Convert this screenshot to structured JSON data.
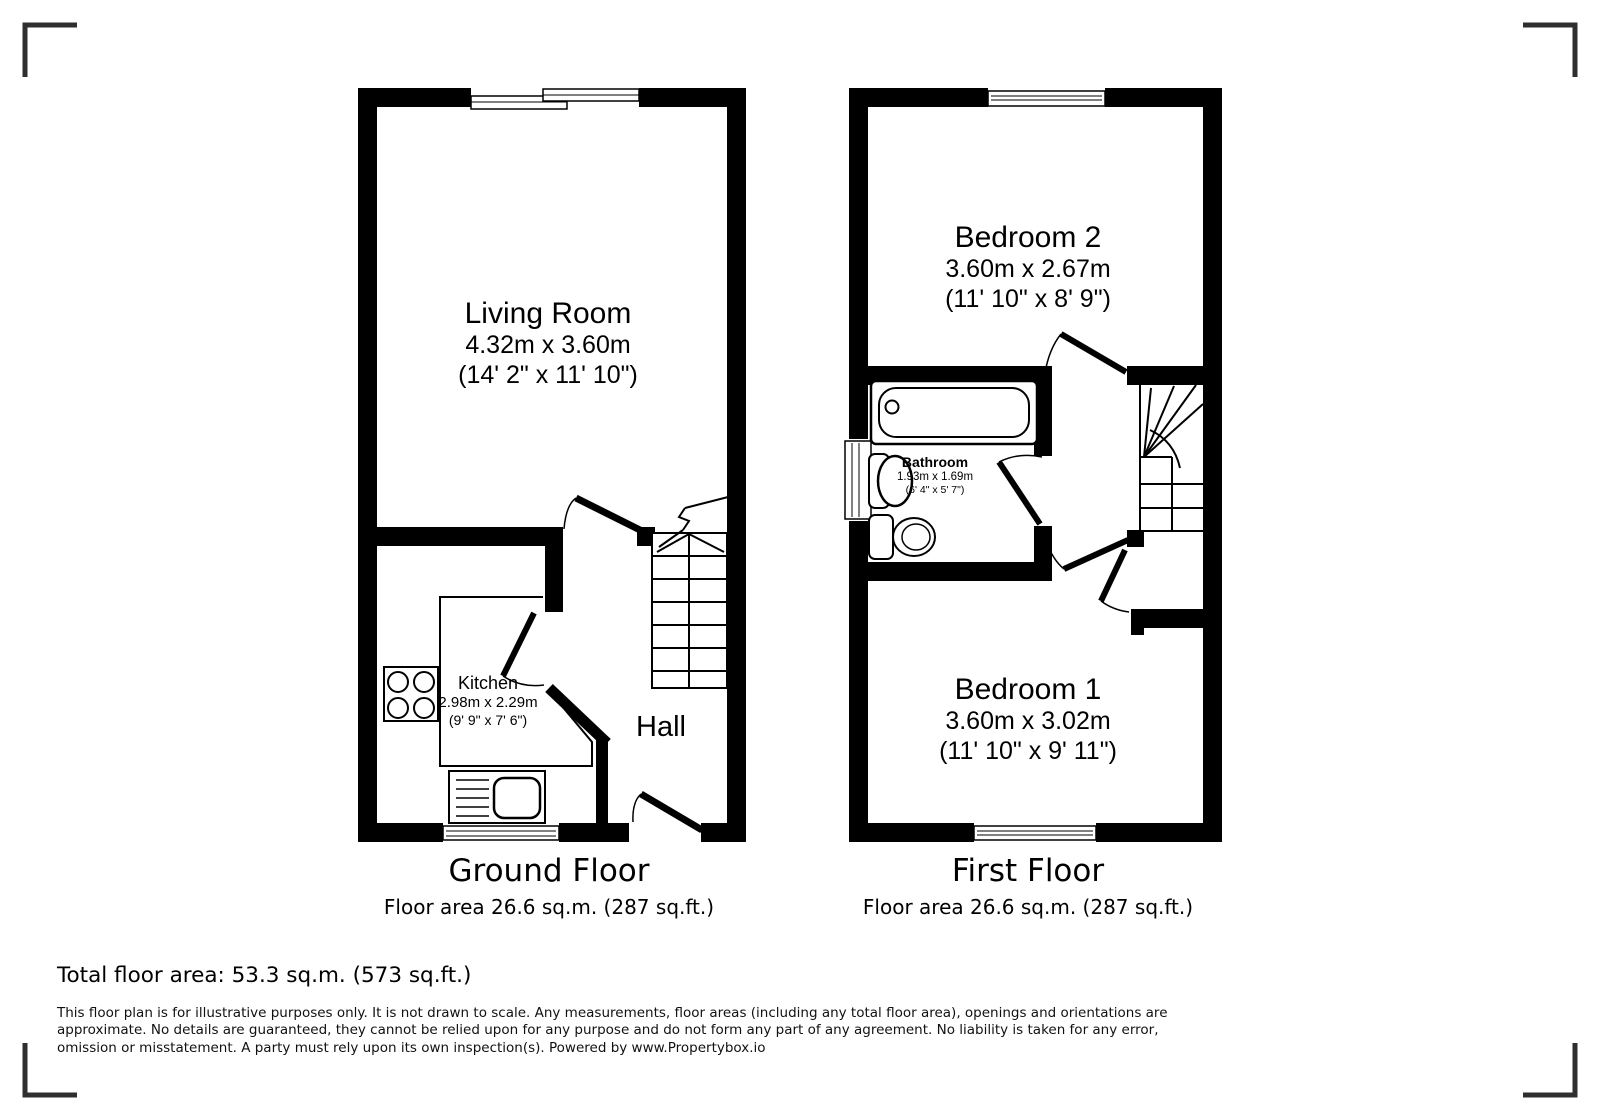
{
  "colors": {
    "wall": "#000000",
    "line": "#000000",
    "corner_mark": "#2f2f2f",
    "background": "#ffffff"
  },
  "floors": {
    "ground": {
      "title": "Ground Floor",
      "area": "Floor area 26.6 sq.m. (287 sq.ft.)",
      "rooms": {
        "living": {
          "name": "Living Room",
          "metric": "4.32m x 3.60m",
          "imperial": "(14' 2\" x 11' 10\")"
        },
        "kitchen": {
          "name": "Kitchen",
          "metric": "2.98m x 2.29m",
          "imperial": "(9' 9\" x 7' 6\")"
        },
        "hall": {
          "name": "Hall"
        }
      }
    },
    "first": {
      "title": "First Floor",
      "area": "Floor area 26.6 sq.m. (287 sq.ft.)",
      "rooms": {
        "bedroom2": {
          "name": "Bedroom 2",
          "metric": "3.60m x 2.67m",
          "imperial": "(11' 10\" x 8' 9\")"
        },
        "bathroom": {
          "name": "Bathroom",
          "metric": "1.93m x 1.69m",
          "imperial": "(6' 4\" x 5' 7\")"
        },
        "bedroom1": {
          "name": "Bedroom 1",
          "metric": "3.60m x 3.02m",
          "imperial": "(11' 10\" x 9' 11\")"
        }
      }
    }
  },
  "summary": {
    "total": "Total floor area: 53.3 sq.m. (573 sq.ft.)"
  },
  "disclaimer": [
    "This floor plan is for illustrative purposes only. It is not drawn to scale. Any measurements, floor areas (including any total floor area), openings and orientations are",
    "approximate. No details are guaranteed, they cannot be relied upon for any purpose and do not form any part of any agreement. No liability is taken for any error,",
    "omission or misstatement. A party must rely upon its own inspection(s). Powered by www.Propertybox.io"
  ]
}
